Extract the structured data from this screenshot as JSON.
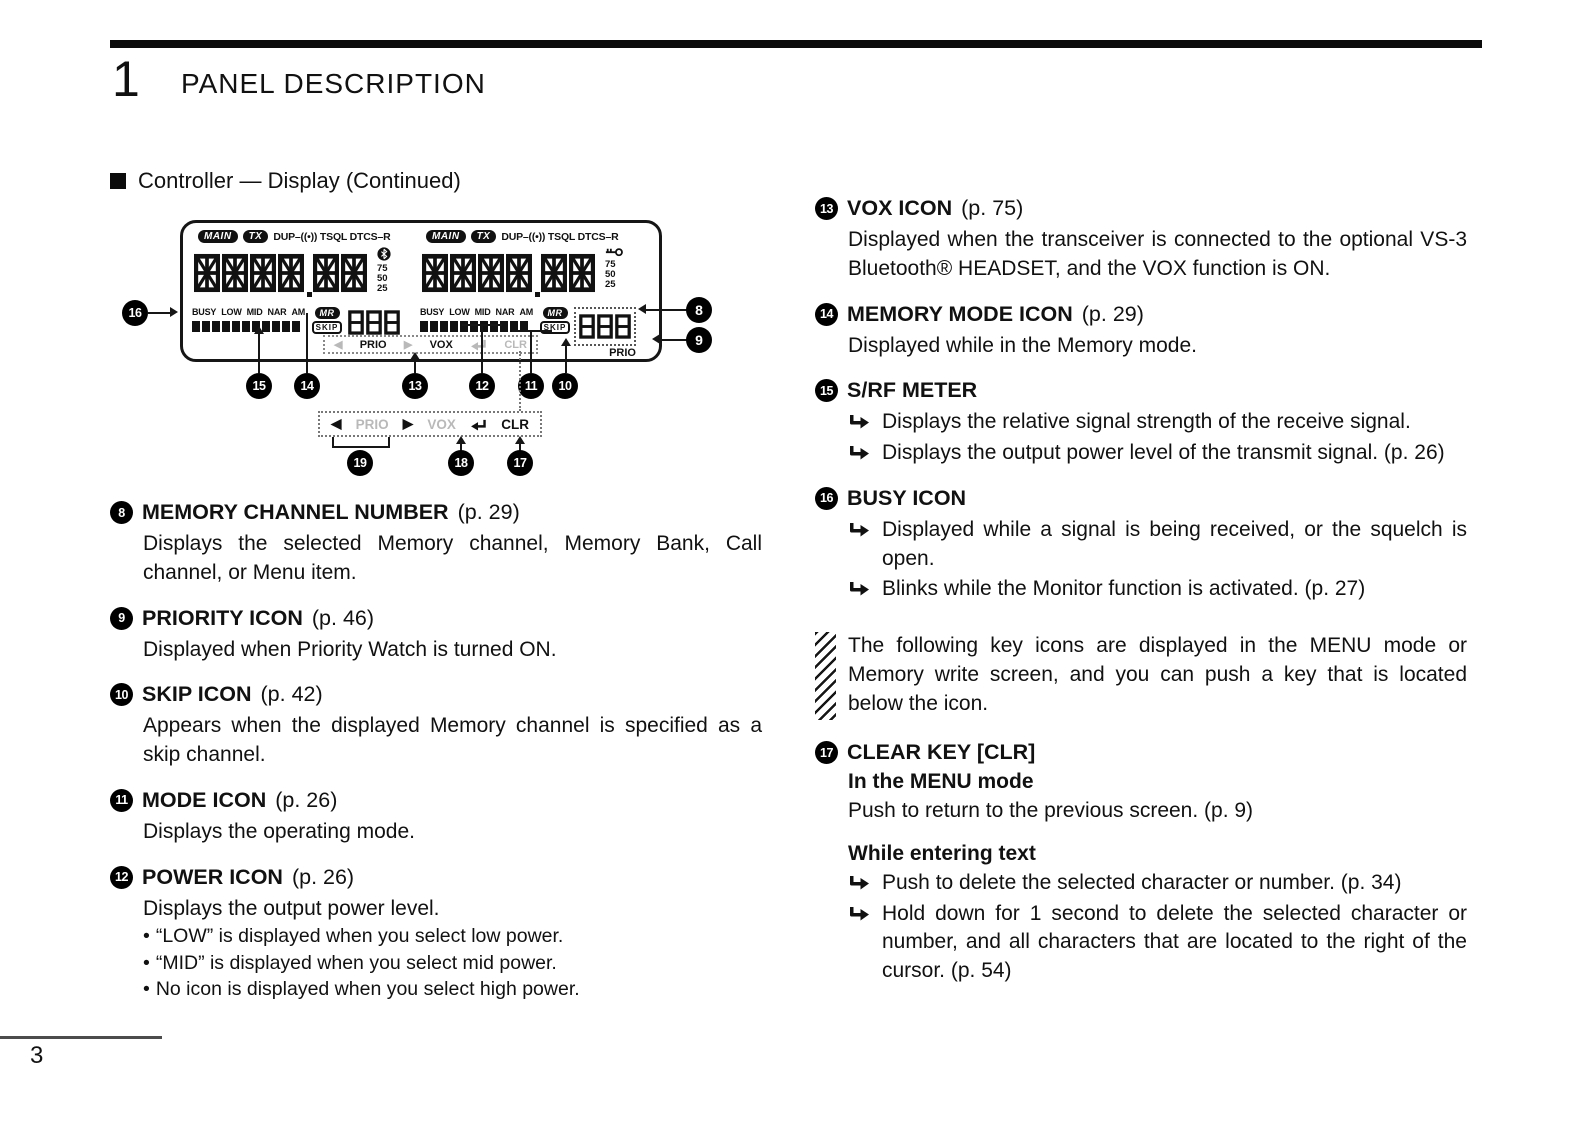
{
  "page": {
    "chapter_number": "1",
    "chapter_title": "PANEL DESCRIPTION",
    "section_marker": "■",
    "section_title": "Controller — Display (Continued)",
    "page_number": "3"
  },
  "lcd": {
    "main_badge": "MAIN",
    "tx_badge": "TX",
    "top_labels": "DUP–((•)) TSQL DTCS–R",
    "meter_scale": [
      "75",
      "50",
      "25"
    ],
    "status_labels": [
      "BUSY",
      "LOW",
      "MID",
      "NAR",
      "AM"
    ],
    "mr_badge": "MR",
    "skip_badge": "SKIP",
    "channel_digits": "888",
    "prio_label": "PRIO",
    "key_row": {
      "left": "◀",
      "prio": "PRIO",
      "right": "▶",
      "vox": "VOX",
      "clr": "CLR"
    }
  },
  "external_key_row": {
    "left": "◀",
    "prio": "PRIO",
    "right": "▶",
    "vox": "VOX",
    "clr": "CLR"
  },
  "callouts": {
    "n8": "8",
    "n9": "9",
    "n10": "10",
    "n11": "11",
    "n12": "12",
    "n13": "13",
    "n14": "14",
    "n15": "15",
    "n16": "16",
    "n17": "17",
    "n18": "18",
    "n19": "19"
  },
  "bullet_char": "•",
  "left_column": [
    {
      "num": "8",
      "title": "MEMORY CHANNEL NUMBER",
      "page_ref": "(p. 29)",
      "body": "Displays the selected Memory channel, Memory Bank, Call channel, or Menu item."
    },
    {
      "num": "9",
      "title": "PRIORITY ICON",
      "page_ref": "(p. 46)",
      "body": "Displayed when Priority Watch is turned ON."
    },
    {
      "num": "10",
      "title": "SKIP ICON",
      "page_ref": "(p. 42)",
      "body": "Appears when the displayed Memory channel is specified as a skip channel."
    },
    {
      "num": "11",
      "title": "MODE ICON",
      "page_ref": "(p. 26)",
      "body": "Displays the operating mode."
    },
    {
      "num": "12",
      "title": "POWER ICON",
      "page_ref": "(p. 26)",
      "body": "Displays the output power level.",
      "bullets": [
        "“LOW” is displayed when you select low power.",
        "“MID” is displayed when you select mid power.",
        "No icon is displayed when you select high power."
      ]
    }
  ],
  "right_column": {
    "vox": {
      "num": "13",
      "title": "VOX ICON",
      "page_ref": "(p. 75)",
      "body": "Displayed when the transceiver is connected to the optional VS-3 Bluetooth® HEADSET, and the VOX function is ON."
    },
    "memory_mode": {
      "num": "14",
      "title": "MEMORY MODE ICON",
      "page_ref": "(p. 29)",
      "body": "Displayed while in the Memory mode."
    },
    "srf_meter": {
      "num": "15",
      "title": "S/RF METER",
      "points": [
        "Displays the relative signal strength of the receive signal.",
        "Displays the output power level of the transmit signal. (p. 26)"
      ]
    },
    "busy": {
      "num": "16",
      "title": "BUSY ICON",
      "points": [
        "Displayed while a signal is being received, or the squelch is open.",
        "Blinks while the Monitor function is activated. (p. 27)"
      ]
    },
    "note": "The following key icons are displayed in the MENU mode or Memory write screen, and you can push a key that is located below the icon.",
    "clear_key": {
      "num": "17",
      "title": "CLEAR KEY [CLR]",
      "subhead_menu": "In the MENU mode",
      "menu_text": "Push to return to the previous screen. (p. 9)",
      "subhead_text": "While entering text",
      "points": [
        "Push to delete the selected character or number. (p. 34)",
        "Hold down for 1 second to delete the selected character or number, and all characters that are located to the right of the cursor. (p. 54)"
      ]
    }
  }
}
